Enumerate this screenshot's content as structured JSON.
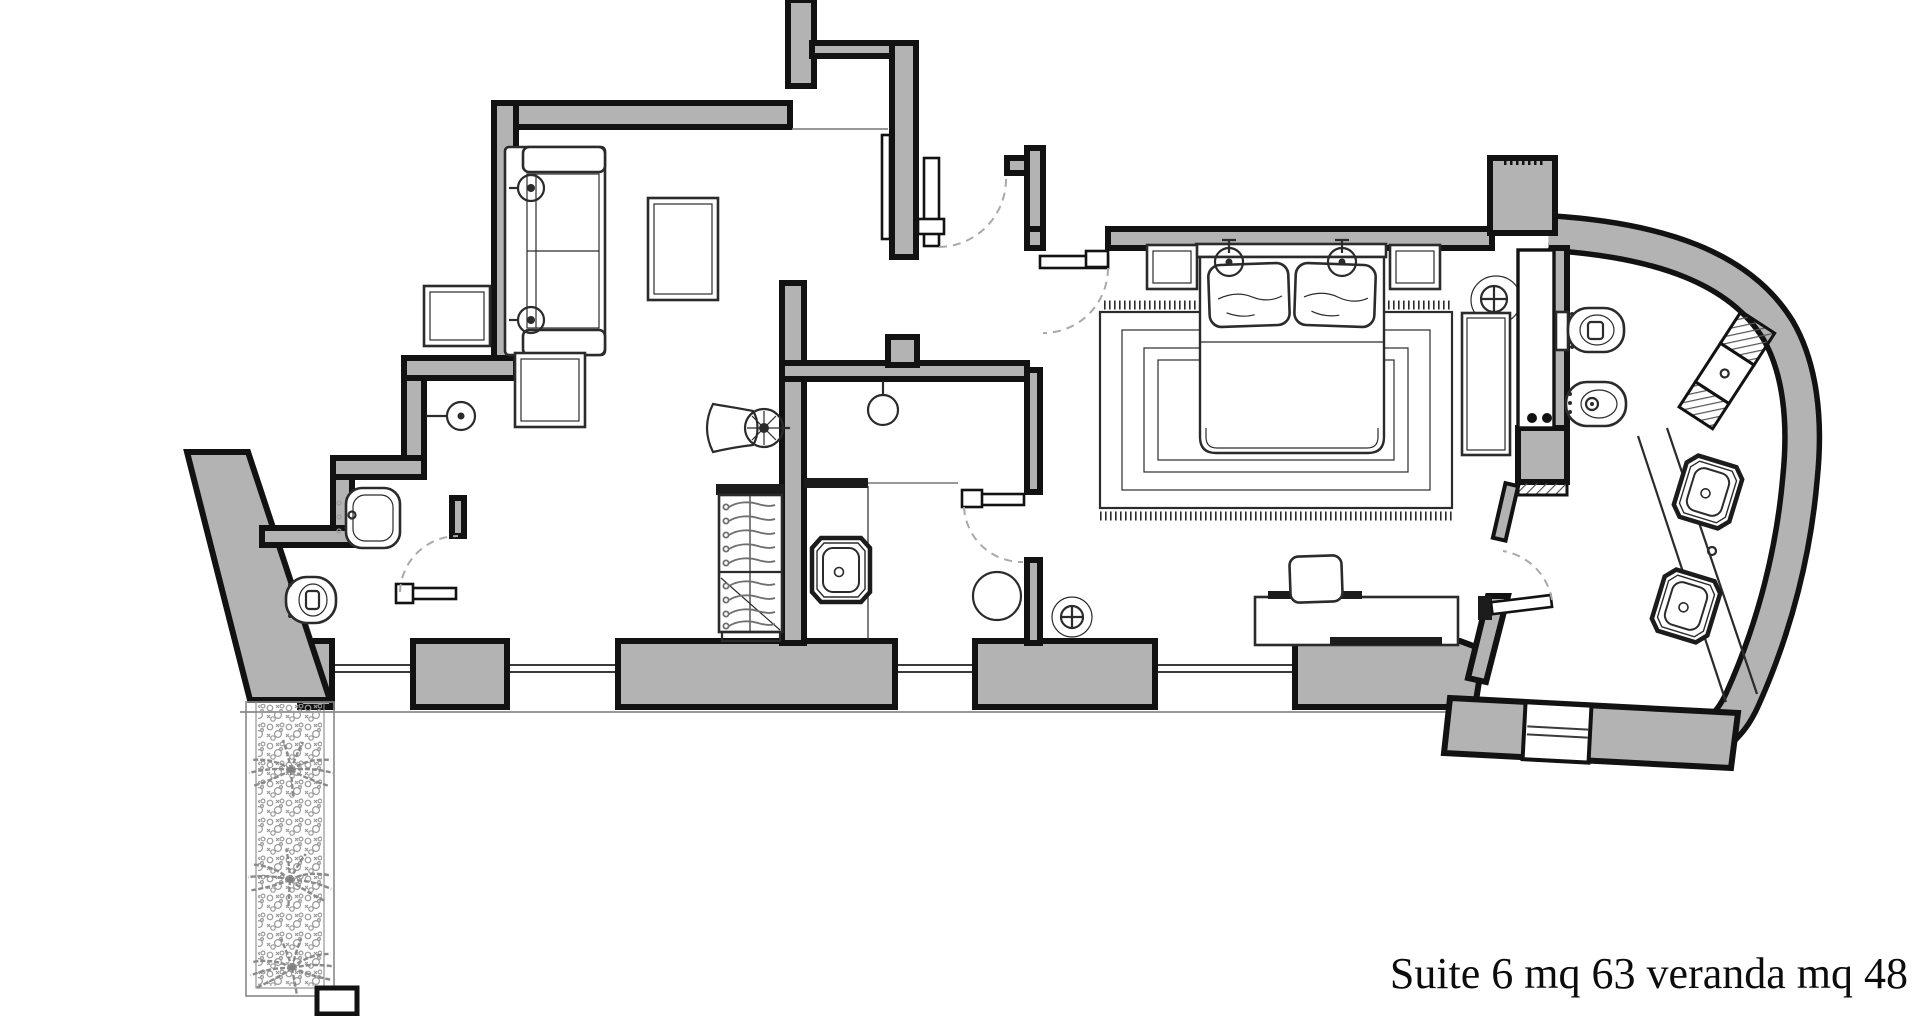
{
  "caption": {
    "text": "Suite 6 mq 63 veranda mq 48",
    "suite_label": "Suite 6",
    "suite_area_mq": "63",
    "veranda_area_mq": "48"
  },
  "colors": {
    "wall_fill": "#b3b3b3",
    "outline": "#121212",
    "furniture_line": "#2b2b2b",
    "door_arc": "#a9a9a9",
    "background": "#ffffff",
    "vegetation": "#8a8a8a"
  },
  "fixtures": {
    "sofa": "sofa-icon",
    "coffee_table": "coffee-table-icon",
    "side_tables": "square-table-icon",
    "wall_lamps": "sconce-icon",
    "wardrobe": "wardrobe-hangers-icon",
    "dressing_chair": "chair-icon",
    "sinks": "washbasin-icon",
    "toilets": "toilet-icon",
    "bidet": "bidet-icon",
    "double_bed": "double-bed-icon",
    "nightstands": "nightstand-icon",
    "rug": "rug-icon",
    "desk": "desk-icon",
    "ceiling_lights": "ceiling-light-icon",
    "palms": "palm-tree-icon",
    "planting_bed": "vegetation-icon"
  }
}
